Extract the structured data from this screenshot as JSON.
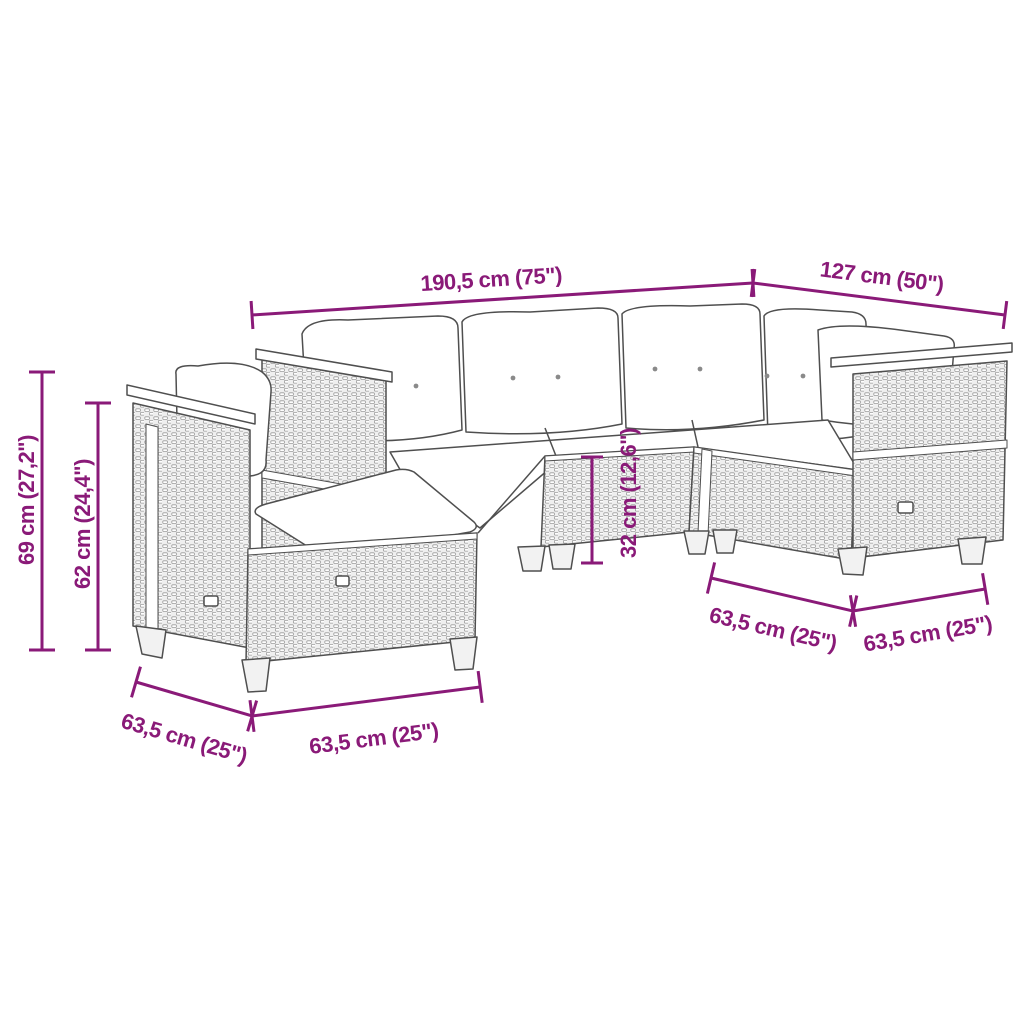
{
  "page": {
    "background_color": "#ffffff"
  },
  "diagram": {
    "type": "furniture-dimension-diagram",
    "subject": "5-piece poly rattan garden lounge set with cushions (L-shaped corner sofa)",
    "accent_color": "#8a1a78",
    "outline_color": "#4f4f4f",
    "dimensions": [
      {
        "id": "total-width",
        "label": "190,5 cm (75\")"
      },
      {
        "id": "right-width",
        "label": "127 cm (50\")"
      },
      {
        "id": "back-height",
        "label": "69 cm (27,2\")"
      },
      {
        "id": "arm-height",
        "label": "62 cm (24,4\")"
      },
      {
        "id": "seat-height",
        "label": "32 cm (12,6\")"
      },
      {
        "id": "left-depth",
        "label": "63,5 cm (25\")"
      },
      {
        "id": "front-module-width",
        "label": "63,5 cm (25\")"
      },
      {
        "id": "right-module-width",
        "label": "63,5 cm (25\")"
      },
      {
        "id": "right-depth",
        "label": "63,5 cm (25\")"
      }
    ]
  }
}
